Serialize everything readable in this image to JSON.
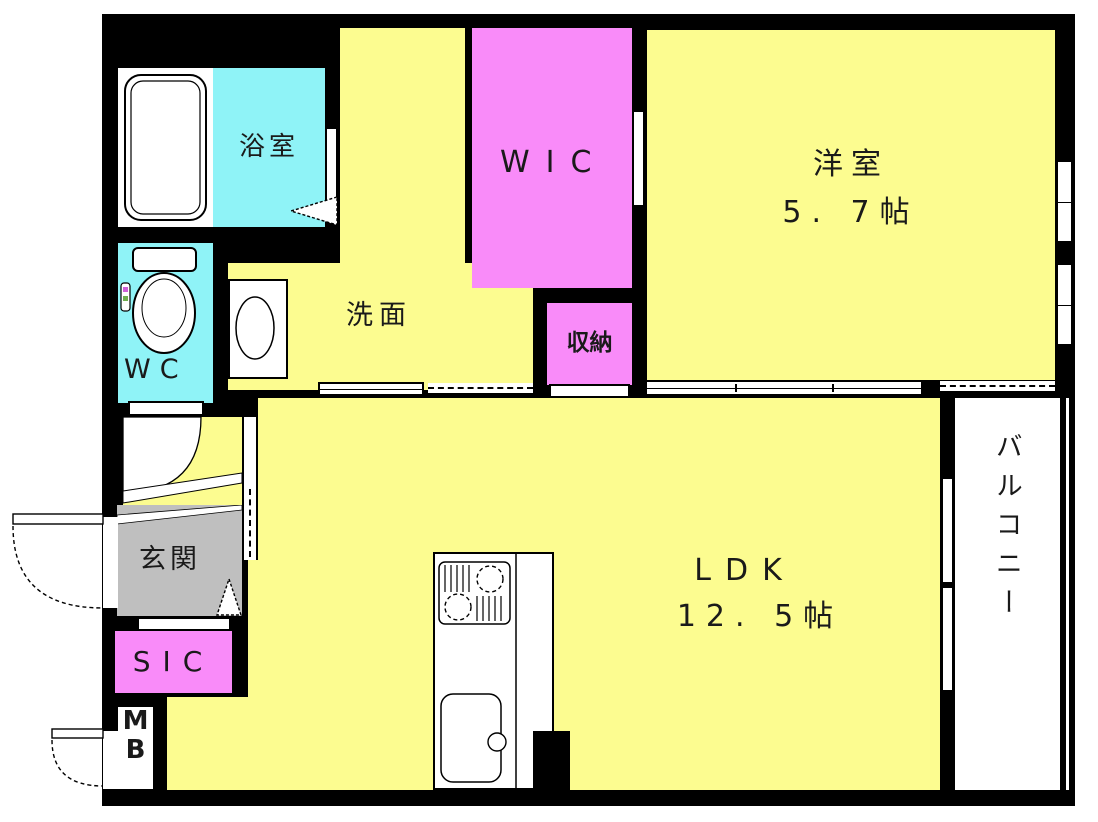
{
  "title": "1LDK apartment floor plan",
  "colors": {
    "room_yellow": "#FCFC90",
    "room_pink": "#F98BF9",
    "room_cyan": "#8FF3F7",
    "entrance_gray": "#BFBFBF",
    "wall_black": "#000000",
    "floor_white": "#FFFFFF"
  },
  "rooms": {
    "bath": {
      "label": "浴室"
    },
    "laundry": {
      "label": "洗"
    },
    "wic": {
      "label": "WIC"
    },
    "western": {
      "label": "洋室",
      "size": "5. 7帖"
    },
    "wc": {
      "label": "WC"
    },
    "washroom": {
      "label": "洗面"
    },
    "storage": {
      "label": "収納"
    },
    "entrance": {
      "label": "玄関"
    },
    "sic": {
      "label": "SIC"
    },
    "meter_box": {
      "label_top": "M",
      "label_bottom": "B"
    },
    "ldk": {
      "label": "LDK",
      "size": "12. 5帖"
    },
    "balcony": {
      "label": "バルコニー"
    }
  }
}
